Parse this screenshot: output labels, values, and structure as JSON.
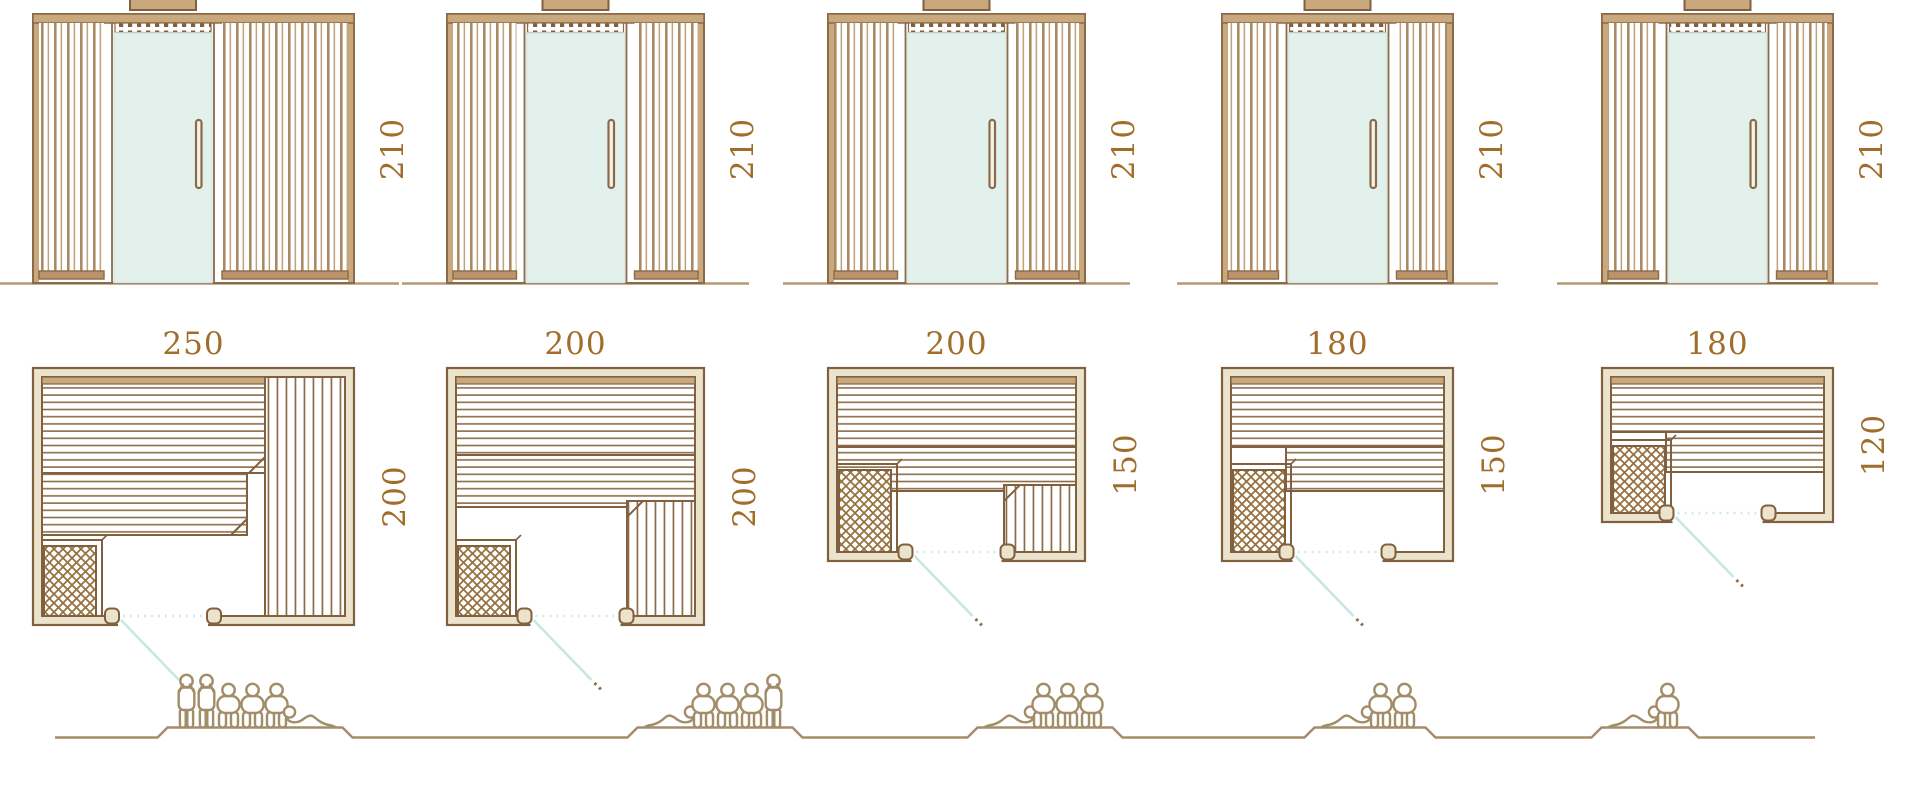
{
  "diagram": {
    "type": "sauna-size-lineup",
    "rows": [
      "front-elevations",
      "floor-plans",
      "capacity-figures"
    ],
    "units": "cm"
  },
  "colors": {
    "outline_brown": "#80603f",
    "slat_tan": "#a98a62",
    "slat_tan_light": "#bfa27b",
    "frame_tan": "#c9a87d",
    "feet_tan": "#bb9569",
    "wall_beige": "#ebe3cb",
    "bench_line": "#8d6c48",
    "heater_hatch": "#96713d",
    "glass_mint": "#e2f1ec",
    "glass_edge": "#d9e8e2",
    "dimension_text": "#a06d2a",
    "door_swing_teal": "#c8e6e0",
    "door_dotted_teal": "#cfe9e3",
    "people_tan": "#a28d68",
    "ground_tan": "#b59a73"
  },
  "saunas": [
    {
      "id": "sauna-1",
      "height_cm": 210,
      "width_cm": 250,
      "depth_cm": 200,
      "plan_layout": "two-tier-back-bench-with-full-right-bench",
      "heater_position": "bottom-left",
      "door_position": "left-of-center",
      "capacity": {
        "standing": 2,
        "seated": 3,
        "lying": 1,
        "total": 6
      },
      "figures": [
        "standing",
        "standing",
        "seated",
        "seated",
        "seated",
        "lying-right"
      ]
    },
    {
      "id": "sauna-2",
      "height_cm": 210,
      "width_cm": 200,
      "depth_cm": 200,
      "plan_layout": "two-tier-back-bench-with-bottom-right-bench",
      "heater_position": "bottom-left",
      "door_position": "center",
      "capacity": {
        "standing": 1,
        "seated": 3,
        "lying": 1,
        "total": 5
      },
      "figures": [
        "lying-left",
        "seated",
        "seated",
        "seated",
        "standing"
      ]
    },
    {
      "id": "sauna-3",
      "height_cm": 210,
      "width_cm": 200,
      "depth_cm": 150,
      "plan_layout": "two-tier-back-bench-with-bottom-right-bench",
      "heater_position": "bottom-left",
      "door_position": "center",
      "capacity": {
        "standing": 0,
        "seated": 3,
        "lying": 1,
        "total": 4
      },
      "figures": [
        "lying-left",
        "seated",
        "seated",
        "seated"
      ]
    },
    {
      "id": "sauna-4",
      "height_cm": 210,
      "width_cm": 180,
      "depth_cm": 150,
      "plan_layout": "two-tier-back-bench",
      "heater_position": "bottom-left",
      "door_position": "center",
      "capacity": {
        "standing": 0,
        "seated": 2,
        "lying": 1,
        "total": 3
      },
      "figures": [
        "lying-left",
        "seated",
        "seated"
      ]
    },
    {
      "id": "sauna-5",
      "height_cm": 210,
      "width_cm": 180,
      "depth_cm": 120,
      "plan_layout": "two-tier-back-bench",
      "heater_position": "bottom-left",
      "door_position": "center",
      "capacity": {
        "standing": 0,
        "seated": 1,
        "lying": 1,
        "total": 2
      },
      "figures": [
        "lying-left",
        "seated"
      ]
    }
  ]
}
